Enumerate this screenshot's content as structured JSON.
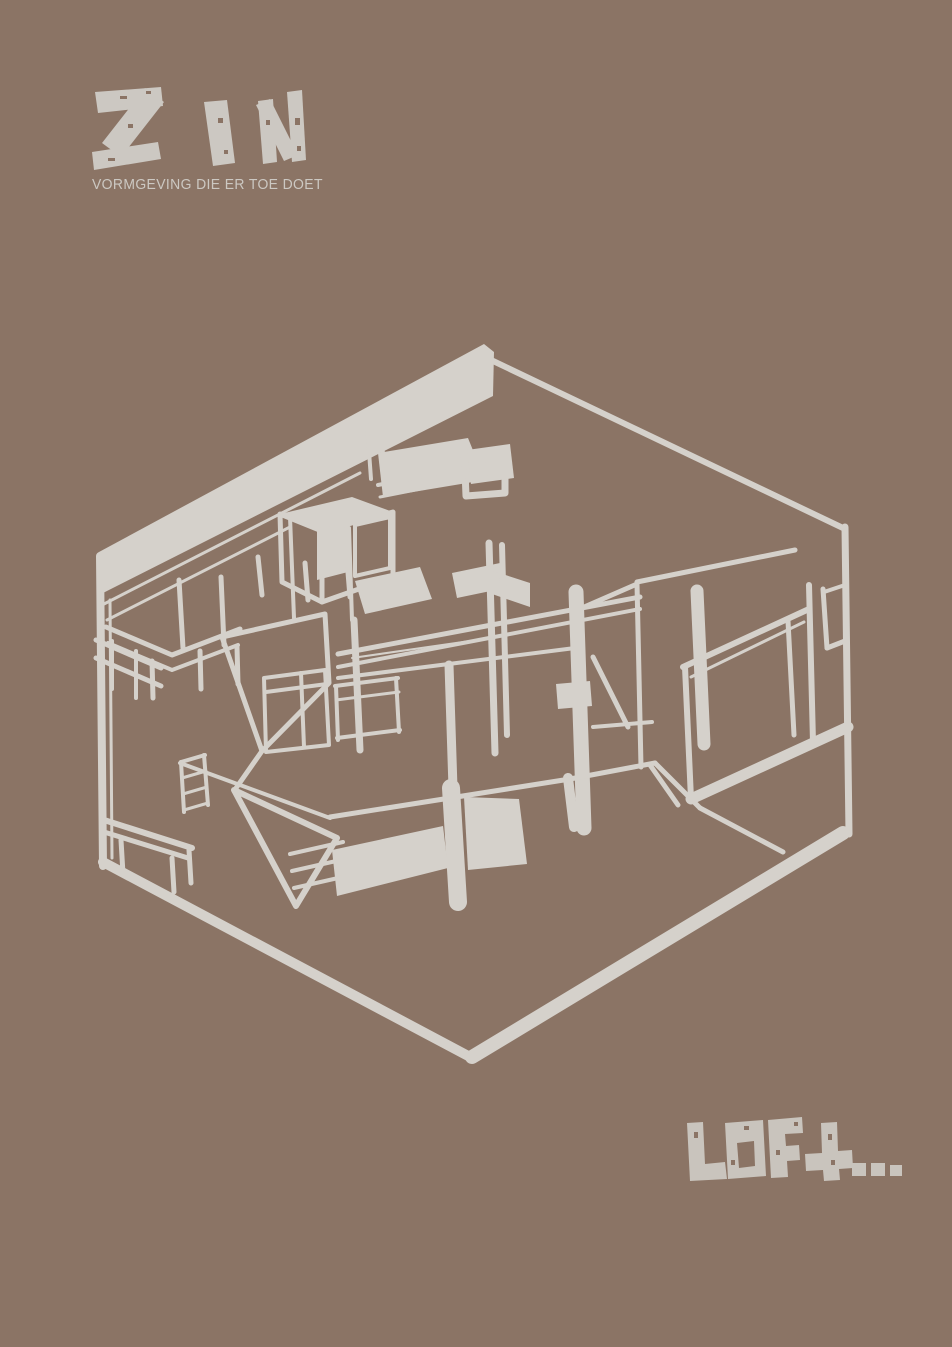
{
  "poster": {
    "background_color": "#8b7465",
    "ink_color": "#d5d1cb",
    "logo": {
      "brand": "ZIN",
      "tagline": "VORMGEVING DIE ER TOE DOET",
      "color": "#ccc8c2"
    },
    "caption": {
      "text": "LOFt...",
      "color": "#c9c4bd"
    },
    "illustration": {
      "name": "hand-drawn isometric cutaway sketch of a loft interior",
      "color": "#d5d1cb"
    }
  }
}
